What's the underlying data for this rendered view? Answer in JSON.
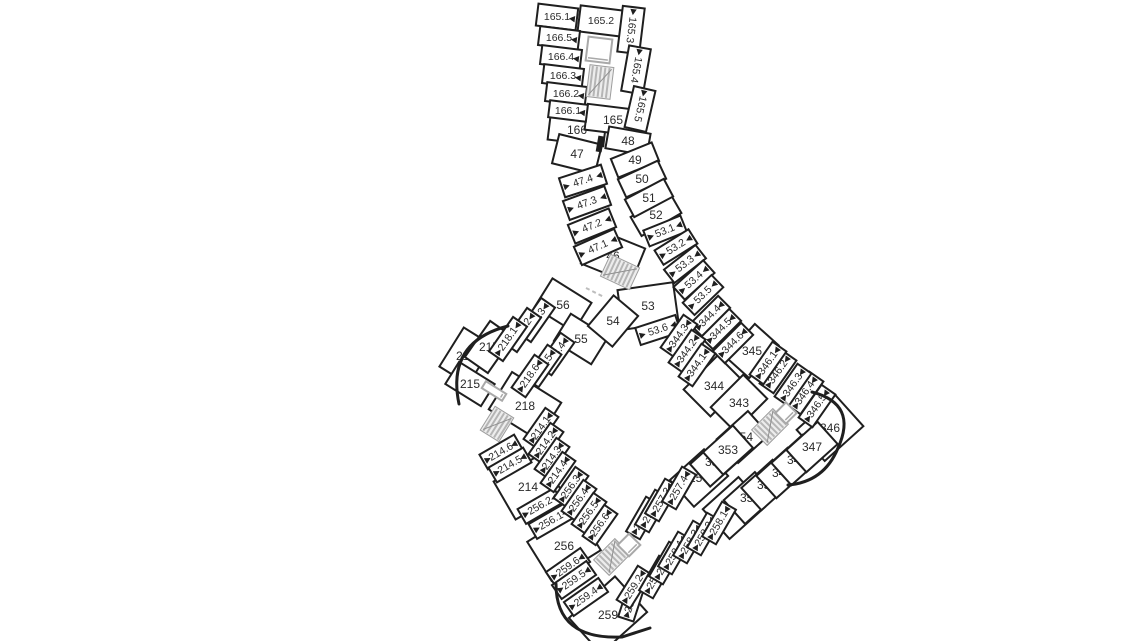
{
  "page": {
    "title": "building-floor-plan",
    "background": "#ffffff"
  },
  "plan": {
    "wall_color": "#1f1f1f",
    "label_color": "#2a2a2a",
    "room_fill": "#ffffff",
    "stair_fill": "#ededed",
    "stair_stripe": "#b5b5b5",
    "elevator_stroke": "#a9a9a9",
    "dash_color": "#bdbdbd",
    "room_fields": [
      "label",
      "cx",
      "cy",
      "w",
      "h",
      "rot",
      "textRot",
      "fontSize",
      "door"
    ],
    "rooms": [
      [
        "165.1",
        557,
        17,
        40,
        22,
        7,
        0,
        10.5,
        "r"
      ],
      [
        "165.2",
        601,
        21,
        44,
        26,
        7,
        0,
        10.5,
        ""
      ],
      [
        "165.3",
        631,
        30,
        46,
        22,
        97,
        97,
        10.5,
        "l"
      ],
      [
        "165.4",
        636,
        70,
        46,
        22,
        100,
        100,
        10.5,
        "l"
      ],
      [
        "165.5",
        640,
        109,
        42,
        22,
        103,
        103,
        10.5,
        "l"
      ],
      [
        "166.5",
        559,
        38,
        40,
        19,
        7,
        0,
        10.5,
        "r"
      ],
      [
        "166.4",
        561,
        57,
        40,
        19,
        7,
        0,
        10.5,
        "r"
      ],
      [
        "166.3",
        563,
        76,
        40,
        19,
        7,
        0,
        10.5,
        "r"
      ],
      [
        "166.2",
        566,
        94,
        40,
        19,
        7,
        0,
        10.5,
        "r"
      ],
      [
        "166.1",
        568,
        111,
        38,
        17,
        7,
        0,
        10.5,
        "r"
      ],
      [
        "166",
        577,
        130,
        56,
        26,
        7,
        0,
        12,
        ""
      ],
      [
        "165",
        613,
        120,
        54,
        26,
        7,
        0,
        12,
        ""
      ],
      [
        "47",
        577,
        154,
        44,
        30,
        14,
        0,
        12,
        ""
      ],
      [
        "47.4",
        583,
        181,
        44,
        20,
        -18,
        null,
        10.5,
        "b"
      ],
      [
        "47.3",
        587,
        203,
        44,
        20,
        -20,
        null,
        10.5,
        "b"
      ],
      [
        "47.2",
        592,
        226,
        44,
        20,
        -22,
        null,
        10.5,
        "b"
      ],
      [
        "47.1",
        598,
        247,
        44,
        20,
        -24,
        null,
        10.5,
        "b"
      ],
      [
        "46",
        613,
        256,
        54,
        38,
        22,
        0,
        12,
        ""
      ],
      [
        "48",
        628,
        141,
        42,
        22,
        10,
        0,
        12,
        ""
      ],
      [
        "49",
        635,
        160,
        44,
        20,
        -22,
        0,
        12,
        ""
      ],
      [
        "50",
        642,
        179,
        44,
        20,
        -25,
        0,
        12,
        ""
      ],
      [
        "51",
        649,
        198,
        44,
        20,
        -28,
        0,
        12,
        ""
      ],
      [
        "52",
        656,
        215,
        46,
        22,
        -30,
        0,
        12,
        ""
      ],
      [
        "53.1",
        665,
        231,
        40,
        17,
        -22,
        null,
        10.5,
        "b"
      ],
      [
        "53.2",
        676,
        247,
        40,
        17,
        -32,
        null,
        10.5,
        "b"
      ],
      [
        "53.3",
        685,
        264,
        40,
        17,
        -38,
        null,
        10.5,
        "b"
      ],
      [
        "53.4",
        694,
        280,
        40,
        17,
        -42,
        null,
        10.5,
        "b"
      ],
      [
        "53.5",
        703,
        295,
        40,
        17,
        -44,
        null,
        10.5,
        "b"
      ],
      [
        "53",
        648,
        306,
        56,
        40,
        -8,
        0,
        12,
        ""
      ],
      [
        "53.6",
        658,
        330,
        42,
        18,
        -18,
        null,
        10.5,
        "b"
      ],
      [
        "56",
        563,
        305,
        46,
        34,
        32,
        0,
        12,
        ""
      ],
      [
        "55",
        581,
        339,
        44,
        32,
        32,
        0,
        12,
        ""
      ],
      [
        "54",
        613,
        321,
        40,
        32,
        -50,
        0,
        12,
        ""
      ],
      [
        "218.3",
        536,
        320,
        42,
        17,
        -55,
        null,
        10.5,
        "b"
      ],
      [
        "218.2",
        522,
        330,
        42,
        17,
        -55,
        null,
        10.5,
        "b"
      ],
      [
        "218.1",
        508,
        339,
        42,
        17,
        -55,
        null,
        10.5,
        "b"
      ],
      [
        "217",
        489,
        347,
        44,
        28,
        -55,
        0,
        12,
        ""
      ],
      [
        "216",
        466,
        356,
        46,
        34,
        -58,
        0,
        12,
        ""
      ],
      [
        "215",
        470,
        384,
        42,
        26,
        32,
        0,
        12,
        ""
      ],
      [
        "218.4",
        556,
        354,
        40,
        17,
        -55,
        null,
        10.5,
        "b"
      ],
      [
        "218.5",
        543,
        366,
        40,
        17,
        -55,
        null,
        10.5,
        "b"
      ],
      [
        "218.6",
        530,
        376,
        40,
        17,
        -55,
        null,
        10.5,
        "b"
      ],
      [
        "218",
        525,
        406,
        58,
        44,
        32,
        0,
        12,
        ""
      ],
      [
        "214.6",
        501,
        452,
        40,
        17,
        -30,
        null,
        10.5,
        "b"
      ],
      [
        "214.5",
        510,
        465,
        40,
        17,
        -30,
        null,
        10.5,
        "b"
      ],
      [
        "214",
        528,
        487,
        54,
        44,
        -30,
        0,
        12,
        ""
      ],
      [
        "214.1",
        541,
        428,
        38,
        16,
        -55,
        null,
        10.5,
        "b"
      ],
      [
        "214.2",
        546,
        443,
        38,
        16,
        -55,
        null,
        10.5,
        "b"
      ],
      [
        "214.3",
        552,
        458,
        38,
        16,
        -55,
        null,
        10.5,
        "b"
      ],
      [
        "214.4",
        558,
        472,
        38,
        16,
        -55,
        null,
        10.5,
        "b"
      ],
      [
        "256.3",
        571,
        487,
        38,
        16,
        -55,
        null,
        10.5,
        "b"
      ],
      [
        "256.4",
        579,
        500,
        38,
        16,
        -55,
        null,
        10.5,
        "b"
      ],
      [
        "256.5",
        589,
        513,
        38,
        16,
        -55,
        null,
        10.5,
        "b"
      ],
      [
        "256.6",
        600,
        525,
        38,
        16,
        -55,
        null,
        10.5,
        "b"
      ],
      [
        "256.2",
        540,
        506,
        42,
        17,
        -30,
        null,
        10.5,
        "b"
      ],
      [
        "256.1",
        551,
        521,
        42,
        17,
        -30,
        null,
        10.5,
        "b"
      ],
      [
        "256",
        564,
        546,
        58,
        46,
        -32,
        0,
        12,
        ""
      ],
      [
        "259.6",
        568,
        567,
        42,
        17,
        -35,
        null,
        10.5,
        "b"
      ],
      [
        "259.5",
        574,
        580,
        42,
        17,
        -35,
        null,
        10.5,
        "b"
      ],
      [
        "259.4",
        586,
        597,
        42,
        17,
        -35,
        null,
        10.5,
        "b"
      ],
      [
        "259",
        608,
        615,
        62,
        48,
        -42,
        0,
        12,
        ""
      ],
      [
        "259.3",
        632,
        600,
        40,
        16,
        -72,
        null,
        10.5,
        "b"
      ],
      [
        "259.2",
        634,
        587,
        40,
        16,
        -58,
        null,
        10.5,
        "b"
      ],
      [
        "259.1",
        656,
        577,
        40,
        16,
        -60,
        null,
        10.5,
        "b"
      ],
      [
        "258.5",
        666,
        563,
        40,
        16,
        -60,
        null,
        10.5,
        "b"
      ],
      [
        "258.4",
        675,
        553,
        40,
        16,
        -60,
        null,
        10.5,
        "b"
      ],
      [
        "258.3",
        690,
        542,
        40,
        16,
        -60,
        null,
        10.5,
        "b"
      ],
      [
        "258.2",
        704,
        534,
        40,
        16,
        -60,
        null,
        10.5,
        "b"
      ],
      [
        "258.1",
        719,
        523,
        40,
        16,
        -60,
        null,
        10.5,
        "b"
      ],
      [
        "258",
        734,
        508,
        48,
        40,
        -42,
        0,
        12,
        ""
      ],
      [
        "257.1",
        643,
        518,
        40,
        16,
        -60,
        null,
        10.5,
        "b"
      ],
      [
        "257.2",
        652,
        511,
        40,
        16,
        -60,
        null,
        10.5,
        "b"
      ],
      [
        "257.3",
        662,
        500,
        40,
        16,
        -60,
        null,
        10.5,
        "b"
      ],
      [
        "257.4",
        679,
        488,
        40,
        16,
        -60,
        null,
        10.5,
        "b"
      ],
      [
        "257",
        699,
        478,
        46,
        36,
        -42,
        0,
        12,
        ""
      ],
      [
        "352",
        715,
        462,
        40,
        30,
        -42,
        0,
        12,
        ""
      ],
      [
        "353",
        728,
        450,
        40,
        30,
        -42,
        0,
        12,
        ""
      ],
      [
        "354",
        743,
        437,
        42,
        32,
        -42,
        0,
        12,
        ""
      ],
      [
        "351",
        750,
        498,
        42,
        32,
        -42,
        0,
        12,
        ""
      ],
      [
        "350",
        767,
        485,
        42,
        30,
        -42,
        0,
        12,
        ""
      ],
      [
        "349",
        782,
        473,
        42,
        30,
        -42,
        0,
        12,
        ""
      ],
      [
        "348",
        797,
        460,
        42,
        30,
        -42,
        0,
        12,
        ""
      ],
      [
        "347",
        812,
        447,
        42,
        30,
        -42,
        0,
        12,
        ""
      ],
      [
        "346",
        830,
        428,
        52,
        42,
        -42,
        0,
        12,
        ""
      ],
      [
        "346.5",
        817,
        406,
        40,
        17,
        -55,
        null,
        10.5,
        "b"
      ],
      [
        "346.4",
        805,
        393,
        40,
        17,
        -55,
        null,
        10.5,
        "b"
      ],
      [
        "346.3",
        793,
        385,
        40,
        17,
        -55,
        null,
        10.5,
        "b"
      ],
      [
        "346.2",
        778,
        372,
        40,
        17,
        -55,
        null,
        10.5,
        "b"
      ],
      [
        "346.1",
        768,
        363,
        40,
        17,
        -55,
        null,
        10.5,
        "b"
      ],
      [
        "345",
        752,
        351,
        44,
        32,
        -48,
        0,
        12,
        ""
      ],
      [
        "344.6",
        733,
        343,
        40,
        17,
        -45,
        null,
        10.5,
        "b"
      ],
      [
        "344.5",
        721,
        329,
        40,
        17,
        -45,
        null,
        10.5,
        "b"
      ],
      [
        "344.4",
        710,
        316,
        40,
        17,
        -45,
        null,
        10.5,
        "b"
      ],
      [
        "344.3",
        679,
        336,
        40,
        17,
        -55,
        null,
        10.5,
        "b"
      ],
      [
        "344.2",
        687,
        351,
        40,
        17,
        -55,
        null,
        10.5,
        "b"
      ],
      [
        "344.1",
        697,
        365,
        40,
        17,
        -55,
        null,
        10.5,
        "b"
      ],
      [
        "344",
        714,
        386,
        48,
        38,
        -45,
        0,
        12,
        ""
      ],
      [
        "343",
        739,
        403,
        46,
        34,
        -45,
        0,
        12,
        ""
      ]
    ],
    "stair_fields": [
      "cx",
      "cy",
      "w",
      "h",
      "rot"
    ],
    "stairs": [
      [
        600,
        82,
        24,
        32,
        7
      ],
      [
        620,
        272,
        32,
        24,
        25
      ],
      [
        497,
        424,
        22,
        28,
        32
      ],
      [
        612,
        557,
        30,
        22,
        -45
      ],
      [
        770,
        427,
        30,
        22,
        -45
      ]
    ],
    "elevators": [
      [
        599,
        50,
        24,
        24,
        7
      ],
      [
        494,
        391,
        8,
        24,
        -58
      ],
      [
        629,
        545,
        16,
        16,
        -45
      ],
      [
        786,
        413,
        15,
        15,
        -45
      ]
    ],
    "solid_blocks": [
      [
        600,
        144,
        6,
        16,
        10
      ]
    ],
    "outer_wall_paths": [
      "M 508 326 Q 446 342 459 404",
      "M 556 584 Q 556 640 622 637 L 650 628",
      "M 812 392 Q 858 404 838 448 Q 824 482 788 485"
    ],
    "dashed_lines": [
      [
        586,
        288,
        604,
        297
      ]
    ]
  }
}
